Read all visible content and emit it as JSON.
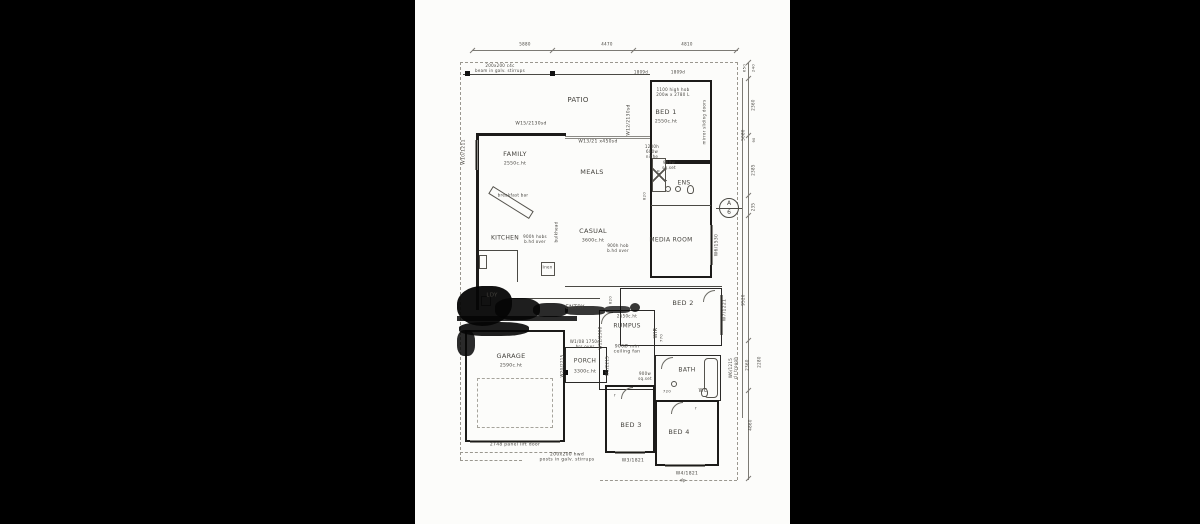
{
  "window": {
    "background": "#000000",
    "paper": "#fcfcfa"
  },
  "plan": {
    "marker": {
      "top": "A",
      "bottom": "6"
    },
    "labels": [
      {
        "t": "PATIO",
        "x": 163,
        "y": 100,
        "s": 7,
        "n": "room-label-patio"
      },
      {
        "t": "BED 1",
        "x": 251,
        "y": 113,
        "s": 6.5,
        "n": "room-label-bed1"
      },
      {
        "t": "2550c.ht",
        "x": 251,
        "y": 122,
        "s": 4.5,
        "n": "ceiling-height-bed1"
      },
      {
        "t": "FAMILY",
        "x": 100,
        "y": 155,
        "s": 6.5,
        "n": "room-label-family"
      },
      {
        "t": "2550c.ht",
        "x": 100,
        "y": 164,
        "s": 4.5,
        "n": "ceiling-height-family"
      },
      {
        "t": "MEALS",
        "x": 177,
        "y": 173,
        "s": 6.5,
        "n": "room-label-meals"
      },
      {
        "t": "ENS",
        "x": 269,
        "y": 183,
        "s": 6,
        "n": "room-label-ens"
      },
      {
        "t": "KITCHEN",
        "x": 90,
        "y": 238,
        "s": 6,
        "n": "room-label-kitchen"
      },
      {
        "t": "CASUAL",
        "x": 178,
        "y": 232,
        "s": 6.5,
        "n": "room-label-casual"
      },
      {
        "t": "3600c.ht",
        "x": 178,
        "y": 241,
        "s": 4.5,
        "n": "ceiling-height-casual"
      },
      {
        "t": "MEDIA ROOM",
        "x": 256,
        "y": 240,
        "s": 6,
        "n": "room-label-media-room"
      },
      {
        "t": "BED 2",
        "x": 268,
        "y": 304,
        "s": 6.5,
        "n": "room-label-bed2"
      },
      {
        "t": "RUMPUS",
        "x": 212,
        "y": 326,
        "s": 6,
        "n": "room-label-rumpus"
      },
      {
        "t": "2550c.ht",
        "x": 212,
        "y": 317,
        "s": 4,
        "n": "ceiling-height-rumpus"
      },
      {
        "t": "900Ø min\nceiling fan",
        "x": 212,
        "y": 350,
        "s": 4.5,
        "n": "note-ceiling-fan"
      },
      {
        "t": "ENTRY",
        "x": 160,
        "y": 308,
        "s": 5.5,
        "n": "room-label-entry"
      },
      {
        "t": "LDY",
        "x": 77,
        "y": 296,
        "s": 5.5,
        "n": "room-label-laundry"
      },
      {
        "t": "GARAGE",
        "x": 96,
        "y": 357,
        "s": 6.5,
        "n": "room-label-garage"
      },
      {
        "t": "2590c.ht",
        "x": 96,
        "y": 366,
        "s": 4.5,
        "n": "ceiling-height-garage"
      },
      {
        "t": "W1/08 1750d\nhrs over",
        "x": 170,
        "y": 345,
        "s": 4,
        "n": "window-label-porch"
      },
      {
        "t": "PORCH",
        "x": 170,
        "y": 361,
        "s": 6,
        "n": "room-label-porch"
      },
      {
        "t": "3300c.ht",
        "x": 170,
        "y": 372,
        "s": 4.5,
        "n": "ceiling-height-porch"
      },
      {
        "t": "BATH",
        "x": 272,
        "y": 370,
        "s": 6,
        "n": "room-label-bath"
      },
      {
        "t": "WC",
        "x": 288,
        "y": 391,
        "s": 5,
        "n": "room-label-wc"
      },
      {
        "t": "BED 3",
        "x": 216,
        "y": 426,
        "s": 6.5,
        "n": "room-label-bed3"
      },
      {
        "t": "BED 4",
        "x": 264,
        "y": 433,
        "s": 6.5,
        "n": "room-label-bed4"
      },
      {
        "t": "WIR",
        "x": 241,
        "y": 333,
        "s": 5,
        "r": -90,
        "n": "room-label-wir"
      },
      {
        "t": "1100 high hob\n200w x 2780 L",
        "x": 258,
        "y": 93,
        "s": 4,
        "n": "note-hob-bed1"
      },
      {
        "t": "mirror sliding doors",
        "x": 290,
        "y": 122,
        "s": 4,
        "r": -90,
        "n": "note-mirror-doors"
      },
      {
        "t": "W15/2130sd",
        "x": 116,
        "y": 124,
        "s": 4.5,
        "n": "window-label-w15"
      },
      {
        "t": "W13/21 x450sd",
        "x": 183,
        "y": 142,
        "s": 4.5,
        "n": "window-label-w13"
      },
      {
        "t": "W12/2130sd",
        "x": 214,
        "y": 120,
        "s": 4.5,
        "r": -90,
        "n": "window-label-w12"
      },
      {
        "t": "1200h\n600w\nniche",
        "x": 237,
        "y": 152,
        "s": 4,
        "n": "note-niche"
      },
      {
        "t": "900w\nsq.set",
        "x": 254,
        "y": 166,
        "s": 4,
        "n": "note-sqset-ens"
      },
      {
        "t": "breakfast bar",
        "x": 98,
        "y": 196,
        "s": 4,
        "n": "note-breakfast-bar"
      },
      {
        "t": "900h hobs\nb.hd over",
        "x": 120,
        "y": 240,
        "s": 4,
        "n": "note-hobs-kitchen"
      },
      {
        "t": "bulkhead",
        "x": 142,
        "y": 232,
        "s": 4,
        "r": -90,
        "n": "note-bulkhead"
      },
      {
        "t": "900h hob\nb.hd over",
        "x": 203,
        "y": 249,
        "s": 4,
        "n": "note-hob-casual"
      },
      {
        "t": "linen",
        "x": 132,
        "y": 268,
        "s": 4,
        "n": "note-linen"
      },
      {
        "t": "W10/1211",
        "x": 49,
        "y": 152,
        "s": 4.5,
        "r": -90,
        "n": "window-label-w10"
      },
      {
        "t": "W7/1221",
        "x": 310,
        "y": 310,
        "s": 4.5,
        "r": -90,
        "n": "window-label-w7"
      },
      {
        "t": "W6/1530",
        "x": 302,
        "y": 245,
        "s": 4.5,
        "r": -90,
        "n": "window-label-w6-media"
      },
      {
        "t": "W6/1215\nclr trough",
        "x": 319,
        "y": 368,
        "s": 4,
        "r": -90,
        "n": "window-label-w6-bath"
      },
      {
        "t": "W3/1821",
        "x": 218,
        "y": 461,
        "s": 4.5,
        "n": "window-label-w3"
      },
      {
        "t": "W4/1821",
        "x": 272,
        "y": 474,
        "s": 4.5,
        "n": "window-label-w4"
      },
      {
        "t": "2748 panel lift door",
        "x": 100,
        "y": 445,
        "s": 4.5,
        "n": "note-panel-lift-door"
      },
      {
        "t": "200x200 hwd\nposts in galv. stirrups",
        "x": 152,
        "y": 458,
        "s": 4.5,
        "n": "note-posts"
      },
      {
        "t": "1809d",
        "x": 226,
        "y": 73,
        "s": 4,
        "n": "window-size-1809d-left"
      },
      {
        "t": "1809d",
        "x": 263,
        "y": 73,
        "s": 4,
        "n": "window-size-1809d-right"
      },
      {
        "t": "200x200 c4c\nbeam in galv. stirrups",
        "x": 85,
        "y": 69,
        "s": 4,
        "n": "note-beam"
      },
      {
        "t": "sh",
        "x": 244,
        "y": 172,
        "s": 4,
        "r": -90,
        "n": "note-shower"
      },
      {
        "t": "dp",
        "x": 268,
        "y": 481,
        "s": 4,
        "n": "note-downpipe"
      },
      {
        "t": "r",
        "x": 200,
        "y": 396,
        "s": 4,
        "n": "note-robe-bed3"
      },
      {
        "t": "r",
        "x": 281,
        "y": 409,
        "s": 4,
        "n": "note-robe-bed4"
      },
      {
        "t": "820",
        "x": 230,
        "y": 196,
        "s": 3.8,
        "r": -90,
        "n": "door-size-820-ens"
      },
      {
        "t": "770",
        "x": 247,
        "y": 338,
        "s": 3.8,
        "r": -90,
        "n": "door-size-770"
      },
      {
        "t": "720",
        "x": 252,
        "y": 392,
        "s": 3.8,
        "n": "door-size-720"
      },
      {
        "t": "820",
        "x": 196,
        "y": 300,
        "s": 3.8,
        "r": -90,
        "n": "door-size-820-hall"
      },
      {
        "t": "900w\nsq.set",
        "x": 230,
        "y": 377,
        "s": 4,
        "n": "note-sqset-hall"
      },
      {
        "t": "W20/2215",
        "x": 148,
        "y": 366,
        "s": 4,
        "r": -90,
        "n": "window-label-w20"
      },
      {
        "t": "W2/2215",
        "x": 193,
        "y": 366,
        "s": 4,
        "r": -90,
        "n": "window-label-w2"
      },
      {
        "t": "W12/2308",
        "x": 186,
        "y": 338,
        "s": 4,
        "r": -90,
        "n": "window-label-w12-rumpus"
      },
      {
        "t": "5880",
        "x": 110,
        "y": 45,
        "s": 4,
        "n": "dim-top-1"
      },
      {
        "t": "4470",
        "x": 192,
        "y": 45,
        "s": 4,
        "n": "dim-top-2"
      },
      {
        "t": "4810",
        "x": 272,
        "y": 45,
        "s": 4,
        "n": "dim-top-3"
      },
      {
        "t": "650",
        "x": 330,
        "y": 68,
        "s": 3.8,
        "r": -90,
        "n": "dim-right-650"
      },
      {
        "t": "240",
        "x": 339,
        "y": 68,
        "s": 3.8,
        "r": -90,
        "n": "dim-right-240"
      },
      {
        "t": "2360",
        "x": 339,
        "y": 105,
        "s": 4,
        "r": -90,
        "n": "dim-right-2360-upper"
      },
      {
        "t": "5080",
        "x": 329,
        "y": 135,
        "s": 4,
        "r": -90,
        "n": "dim-right-5080"
      },
      {
        "t": "90",
        "x": 339,
        "y": 140,
        "s": 3.5,
        "r": -90,
        "n": "dim-right-90"
      },
      {
        "t": "2385",
        "x": 339,
        "y": 170,
        "s": 4,
        "r": -90,
        "n": "dim-right-2385"
      },
      {
        "t": "235",
        "x": 339,
        "y": 207,
        "s": 4,
        "r": -90,
        "n": "dim-right-235"
      },
      {
        "t": "9520",
        "x": 329,
        "y": 300,
        "s": 4,
        "r": -90,
        "n": "dim-right-9520"
      },
      {
        "t": "2280",
        "x": 345,
        "y": 362,
        "s": 4,
        "r": -90,
        "n": "dim-right-2280"
      },
      {
        "t": "2360",
        "x": 333,
        "y": 365,
        "s": 4,
        "r": -90,
        "n": "dim-right-2360-lower"
      },
      {
        "t": "4860",
        "x": 336,
        "y": 425,
        "s": 4,
        "r": -90,
        "n": "dim-right-4860"
      }
    ]
  }
}
